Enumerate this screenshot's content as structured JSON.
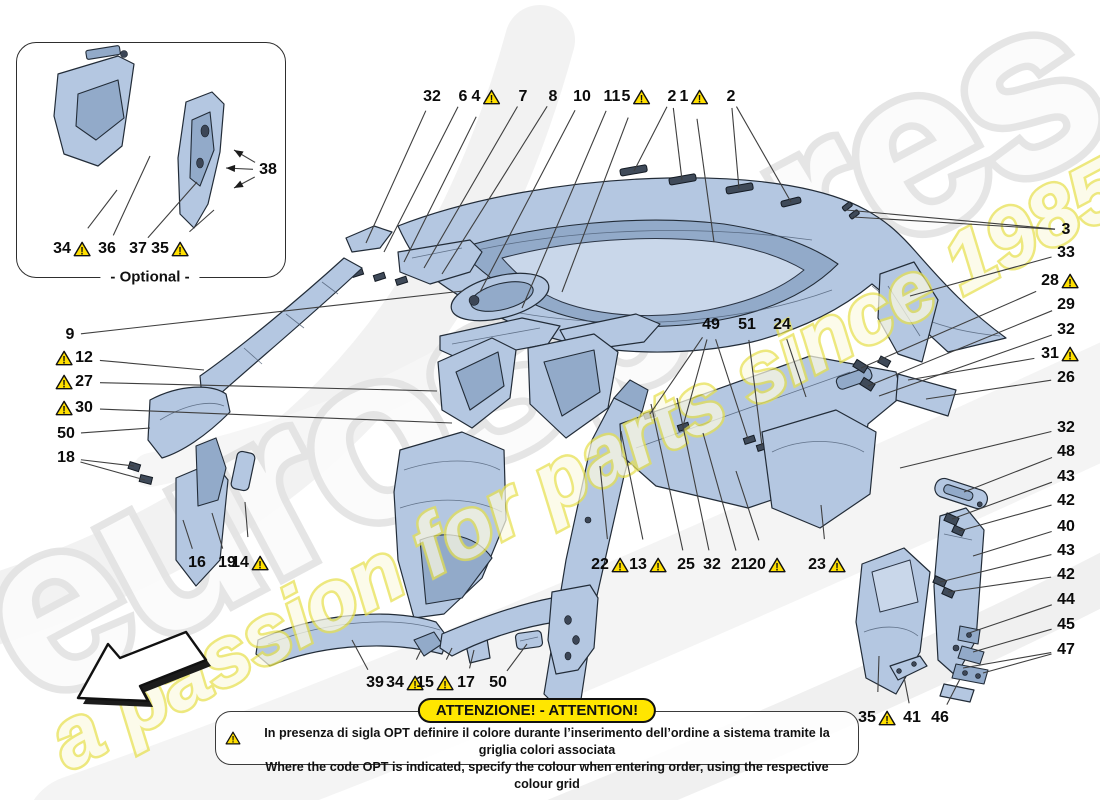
{
  "watermark": {
    "brand": "eurospares",
    "tagline": "a passion for parts since 1985",
    "gray": "#e3e3e3",
    "yellow": "#e7e04d"
  },
  "optional_box": {
    "label": "- Optional -"
  },
  "attention": {
    "title": "ATTENZIONE! - ATTENTION!",
    "line1": "In presenza di sigla OPT definire il colore durante l’inserimento dell’ordine a sistema tramite la griglia colori associata",
    "line2": "Where the code OPT is indicated, specify the colour when entering order, using the respective colour grid",
    "pill_bg": "#ffe600",
    "warn_yellow": "#ffdf00"
  },
  "callouts": [
    {
      "n": "32",
      "x": 432,
      "y": 97,
      "t": [
        [
          366,
          243
        ]
      ]
    },
    {
      "n": "6",
      "x": 463,
      "y": 97,
      "t": [
        [
          384,
          252
        ]
      ]
    },
    {
      "n": "4",
      "x": 486,
      "y": 97,
      "w": "r",
      "t": [
        [
          404,
          262
        ]
      ]
    },
    {
      "n": "7",
      "x": 523,
      "y": 97,
      "t": [
        [
          424,
          268
        ]
      ]
    },
    {
      "n": "8",
      "x": 553,
      "y": 97,
      "t": [
        [
          442,
          274
        ]
      ]
    },
    {
      "n": "10",
      "x": 582,
      "y": 97,
      "t": [
        [
          480,
          292
        ]
      ]
    },
    {
      "n": "11",
      "x": 612,
      "y": 97,
      "t": [
        [
          522,
          308
        ]
      ]
    },
    {
      "n": "5",
      "x": 636,
      "y": 97,
      "w": "r",
      "t": [
        [
          562,
          292
        ]
      ]
    },
    {
      "n": "2",
      "x": 672,
      "y": 97,
      "t": [
        [
          634,
          171
        ],
        [
          682,
          180
        ]
      ]
    },
    {
      "n": "1",
      "x": 694,
      "y": 97,
      "w": "r",
      "t": [
        [
          714,
          242
        ]
      ]
    },
    {
      "n": "2",
      "x": 731,
      "y": 97,
      "t": [
        [
          739,
          189
        ],
        [
          791,
          202
        ]
      ]
    },
    {
      "n": "3",
      "x": 1066,
      "y": 230,
      "t": [
        [
          846,
          210
        ],
        [
          853,
          217
        ]
      ]
    },
    {
      "n": "33",
      "x": 1066,
      "y": 253,
      "t": [
        [
          910,
          296
        ]
      ]
    },
    {
      "n": "28",
      "x": 1060,
      "y": 281,
      "w": "r",
      "t": [
        [
          861,
          368
        ]
      ]
    },
    {
      "n": "29",
      "x": 1066,
      "y": 305,
      "t": [
        [
          868,
          386
        ]
      ]
    },
    {
      "n": "32",
      "x": 1066,
      "y": 330,
      "t": [
        [
          879,
          396
        ]
      ]
    },
    {
      "n": "31",
      "x": 1060,
      "y": 354,
      "w": "r",
      "t": [
        [
          908,
          380
        ]
      ]
    },
    {
      "n": "26",
      "x": 1066,
      "y": 378,
      "t": [
        [
          926,
          399
        ]
      ]
    },
    {
      "n": "32",
      "x": 1066,
      "y": 428,
      "t": [
        [
          900,
          468
        ]
      ]
    },
    {
      "n": "48",
      "x": 1066,
      "y": 452,
      "t": [
        [
          964,
          492
        ]
      ]
    },
    {
      "n": "43",
      "x": 1066,
      "y": 477,
      "t": [
        [
          952,
          519
        ]
      ]
    },
    {
      "n": "42",
      "x": 1066,
      "y": 501,
      "t": [
        [
          959,
          531
        ]
      ]
    },
    {
      "n": "40",
      "x": 1066,
      "y": 527,
      "t": [
        [
          973,
          556
        ]
      ]
    },
    {
      "n": "43",
      "x": 1066,
      "y": 551,
      "t": [
        [
          940,
          582
        ]
      ]
    },
    {
      "n": "42",
      "x": 1066,
      "y": 575,
      "t": [
        [
          948,
          592
        ]
      ]
    },
    {
      "n": "44",
      "x": 1066,
      "y": 600,
      "t": [
        [
          969,
          633
        ]
      ]
    },
    {
      "n": "45",
      "x": 1066,
      "y": 625,
      "t": [
        [
          973,
          652
        ]
      ]
    },
    {
      "n": "47",
      "x": 1066,
      "y": 650,
      "t": [
        [
          963,
          668
        ],
        [
          983,
          673
        ]
      ]
    },
    {
      "n": "9",
      "x": 70,
      "y": 335,
      "t": [
        [
          463,
          291
        ]
      ]
    },
    {
      "n": "12",
      "x": 74,
      "y": 358,
      "w": "l",
      "t": [
        [
          204,
          370
        ]
      ]
    },
    {
      "n": "27",
      "x": 74,
      "y": 382,
      "w": "l",
      "t": [
        [
          437,
          391
        ]
      ]
    },
    {
      "n": "30",
      "x": 74,
      "y": 408,
      "w": "l",
      "t": [
        [
          452,
          423
        ]
      ]
    },
    {
      "n": "50",
      "x": 66,
      "y": 434,
      "t": [
        [
          150,
          428
        ]
      ]
    },
    {
      "n": "18",
      "x": 66,
      "y": 458,
      "t": [
        [
          134,
          466
        ],
        [
          145,
          480
        ]
      ]
    },
    {
      "n": "16",
      "x": 197,
      "y": 563,
      "t": [
        [
          183,
          520
        ]
      ]
    },
    {
      "n": "19",
      "x": 227,
      "y": 563,
      "t": [
        [
          212,
          513
        ]
      ]
    },
    {
      "n": "14",
      "x": 250,
      "y": 563,
      "w": "r",
      "t": [
        [
          245,
          502
        ]
      ]
    },
    {
      "n": "49",
      "x": 711,
      "y": 325,
      "t": [
        [
          650,
          414
        ],
        [
          683,
          426
        ],
        [
          748,
          439
        ]
      ]
    },
    {
      "n": "51",
      "x": 747,
      "y": 325,
      "t": [
        [
          762,
          446
        ]
      ]
    },
    {
      "n": "24",
      "x": 782,
      "y": 325,
      "t": [
        [
          806,
          397
        ]
      ]
    },
    {
      "n": "22",
      "x": 610,
      "y": 565,
      "w": "r",
      "t": [
        [
          600,
          466
        ]
      ]
    },
    {
      "n": "13",
      "x": 648,
      "y": 565,
      "w": "r",
      "t": [
        [
          621,
          431
        ]
      ]
    },
    {
      "n": "25",
      "x": 686,
      "y": 565,
      "t": [
        [
          651,
          404
        ]
      ]
    },
    {
      "n": "32",
      "x": 712,
      "y": 565,
      "t": [
        [
          677,
          398
        ]
      ]
    },
    {
      "n": "21",
      "x": 740,
      "y": 565,
      "t": [
        [
          703,
          433
        ]
      ]
    },
    {
      "n": "20",
      "x": 767,
      "y": 565,
      "w": "r",
      "t": [
        [
          736,
          471
        ]
      ]
    },
    {
      "n": "23",
      "x": 827,
      "y": 565,
      "w": "r",
      "t": [
        [
          821,
          505
        ]
      ]
    },
    {
      "n": "39",
      "x": 375,
      "y": 683,
      "t": [
        [
          352,
          640
        ]
      ]
    },
    {
      "n": "34",
      "x": 405,
      "y": 683,
      "w": "r",
      "t": [
        [
          421,
          650
        ]
      ]
    },
    {
      "n": "15",
      "x": 435,
      "y": 683,
      "w": "r",
      "t": [
        [
          452,
          648
        ]
      ]
    },
    {
      "n": "17",
      "x": 466,
      "y": 683,
      "t": [
        [
          474,
          650
        ]
      ]
    },
    {
      "n": "50",
      "x": 498,
      "y": 683,
      "t": [
        [
          527,
          644
        ]
      ]
    },
    {
      "n": "35",
      "x": 877,
      "y": 718,
      "w": "r",
      "t": [
        [
          879,
          656
        ]
      ]
    },
    {
      "n": "41",
      "x": 912,
      "y": 718,
      "t": [
        [
          904,
          677
        ]
      ]
    },
    {
      "n": "46",
      "x": 940,
      "y": 718,
      "t": [
        [
          960,
          679
        ]
      ]
    },
    {
      "n": "34",
      "x": 72,
      "y": 249,
      "w": "r",
      "t": [
        [
          117,
          190
        ]
      ]
    },
    {
      "n": "36",
      "x": 107,
      "y": 249,
      "t": [
        [
          150,
          156
        ]
      ]
    },
    {
      "n": "37",
      "x": 138,
      "y": 249,
      "t": [
        [
          197,
          182
        ]
      ]
    },
    {
      "n": "35",
      "x": 170,
      "y": 249,
      "w": "r",
      "t": [
        [
          214,
          210
        ]
      ]
    },
    {
      "n": "38",
      "x": 268,
      "y": 170,
      "arrow": true,
      "t": [
        [
          234,
          150
        ],
        [
          226,
          168
        ],
        [
          234,
          188
        ]
      ]
    }
  ]
}
